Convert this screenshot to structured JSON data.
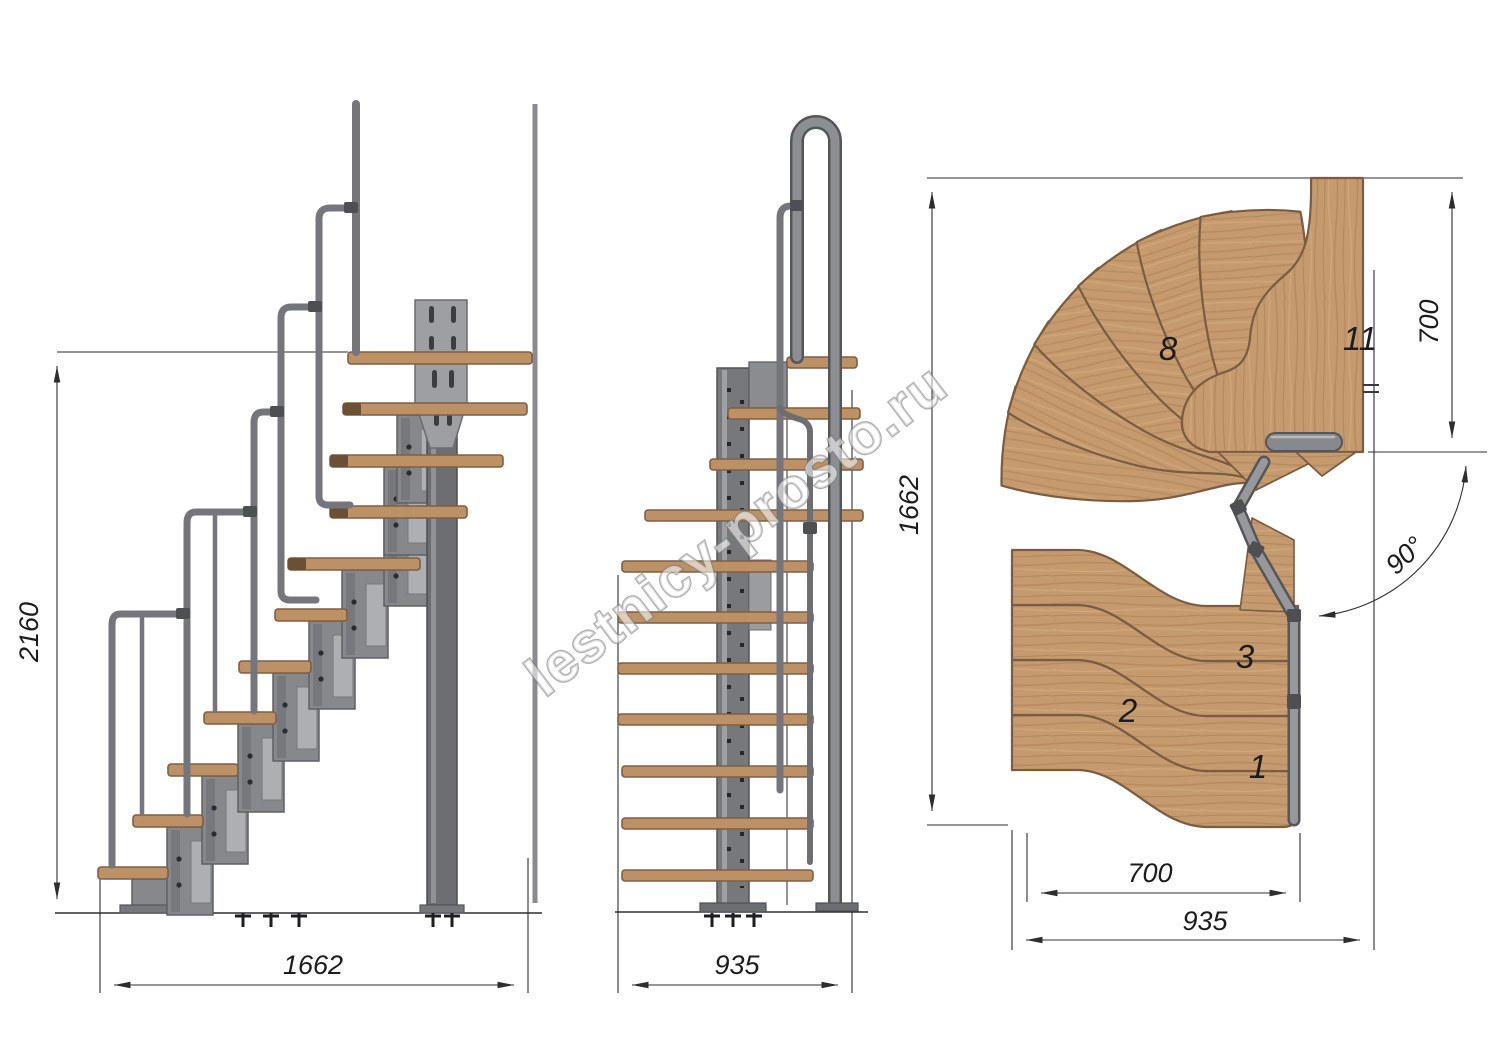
{
  "watermark": {
    "text": "lestnicy-prosto.ru"
  },
  "dimensions": {
    "side_height": "2160",
    "side_length": "1662",
    "front_width": "935",
    "plan_height": "1662",
    "plan_landing_depth": "700",
    "plan_turn_angle": "90°",
    "plan_flight_width": "700",
    "plan_total_width": "935"
  },
  "tread_labels": {
    "step1": "1",
    "step2": "2",
    "step3": "3",
    "step8": "8",
    "step11": "11"
  },
  "colors": {
    "wood": "#c59a6e",
    "wood_seam": "#7b5c40",
    "metal": "#7e7f84",
    "metal_dark": "#55565a",
    "stand": "#8b8c90",
    "dimension_line": "#2e2e2e"
  }
}
